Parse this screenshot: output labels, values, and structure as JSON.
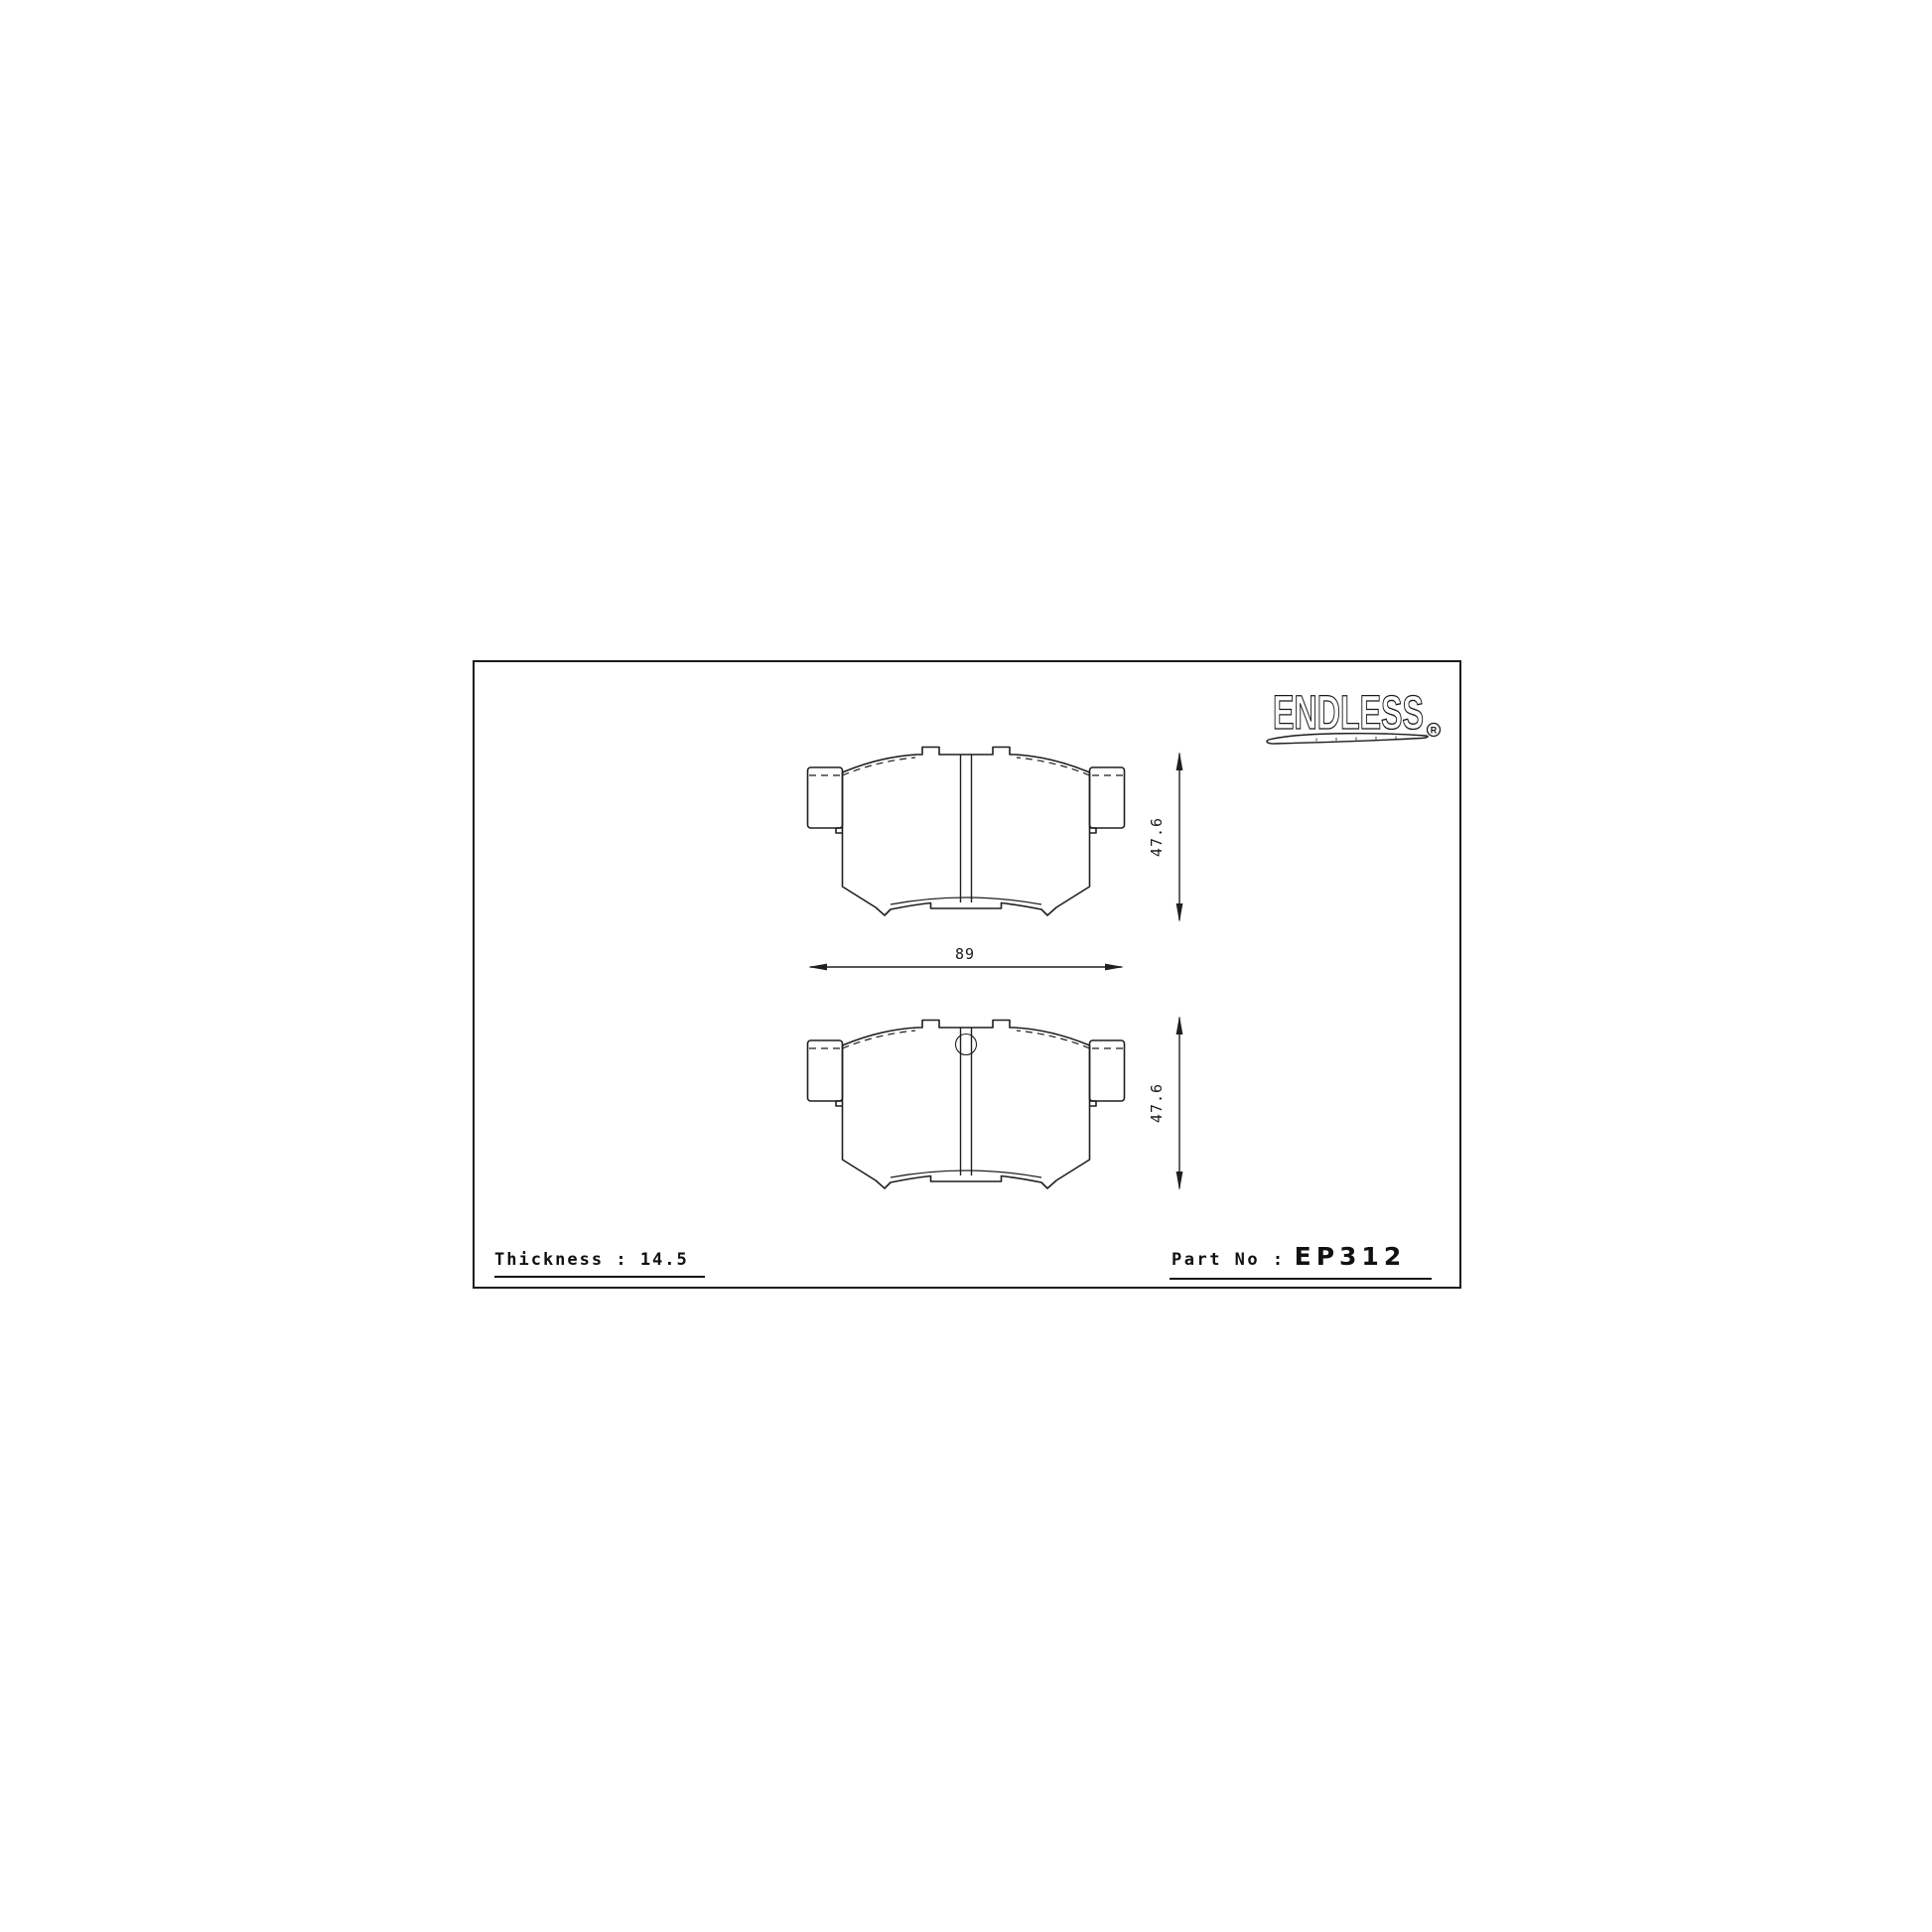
{
  "page": {
    "background": "#ffffff",
    "line_color": "#1f1f1f"
  },
  "logo": {
    "text": "ENDLESS",
    "registered_mark": "R"
  },
  "drawing": {
    "top_view": {
      "name": "brake-pad-rear-view",
      "height_dim": "47.6",
      "has_center_hole": false
    },
    "bottom_view": {
      "name": "brake-pad-front-view",
      "height_dim": "47.6",
      "has_center_hole": true
    },
    "width_dim": "89"
  },
  "footer": {
    "thickness_label": "Thickness : 14.5",
    "part_no_label": "Part No :",
    "part_number": "EP312"
  }
}
